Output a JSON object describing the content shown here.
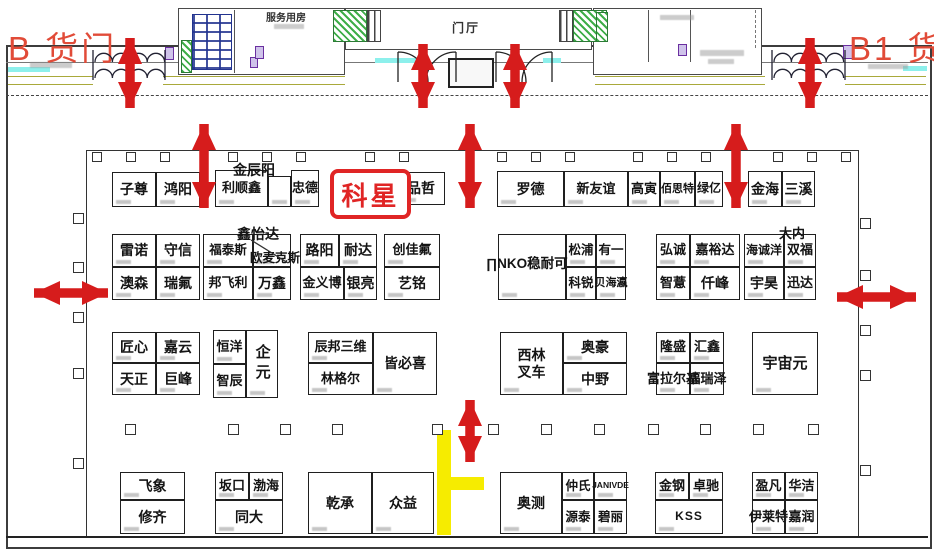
{
  "title_area": {
    "gate_left": "B 货门",
    "gate_right": "B1 货门",
    "service_room_label": "服务用房",
    "foyer_label": "门厅"
  },
  "highlight_booth": "科星",
  "booths": {
    "r1": [
      "子尊",
      "鸿阳",
      "金辰阳",
      "利顺鑫",
      "忠德",
      "品哲",
      "罗德",
      "新友谊",
      "高寅",
      "佰思特",
      "绿亿",
      "金海",
      "三溪"
    ],
    "r2": [
      "雷诺",
      "守信",
      "澳森",
      "瑞氟",
      "鑫怡达",
      "福泰斯",
      "欧麦克斯",
      "邦飞利",
      "万鑫",
      "路阳",
      "耐达",
      "金义博",
      "银亮",
      "创佳氟",
      "艺铭",
      "∏NKO稳耐可",
      "松浦",
      "有一",
      "科锐",
      "贝海瀛",
      "弘诚",
      "嘉裕达",
      "智薏",
      "仟峰",
      "大内",
      "海诚洋",
      "双福",
      "宇昊",
      "迅达"
    ],
    "r3": [
      "匠心",
      "嘉云",
      "天正",
      "巨峰",
      "恒洋",
      "智辰",
      "企元",
      "辰邦三维",
      "林格尔",
      "皆必喜",
      "西林叉车",
      "奥豪",
      "中野",
      "隆盛",
      "汇鑫",
      "富拉尔基",
      "福瑞泽",
      "宇宙元"
    ],
    "r4": [
      "飞象",
      "修齐",
      "坂口",
      "渤海",
      "同大",
      "乾承",
      "众益",
      "奥测",
      "仲氏",
      "JANIVDE",
      "源泰",
      "碧丽",
      "金钢",
      "卓驰",
      "KSS",
      "盈凡",
      "华洁",
      "伊莱特",
      "嘉润"
    ]
  },
  "colors": {
    "arrow_red": "#d61c1c",
    "highlight_red": "#e02525",
    "gate_red": "#e14b38",
    "path_yellow": "#f6ec00",
    "stair_green": "#3fae49",
    "accent_cyan": "#8df0ec",
    "line_olive": "#a9a93a"
  }
}
